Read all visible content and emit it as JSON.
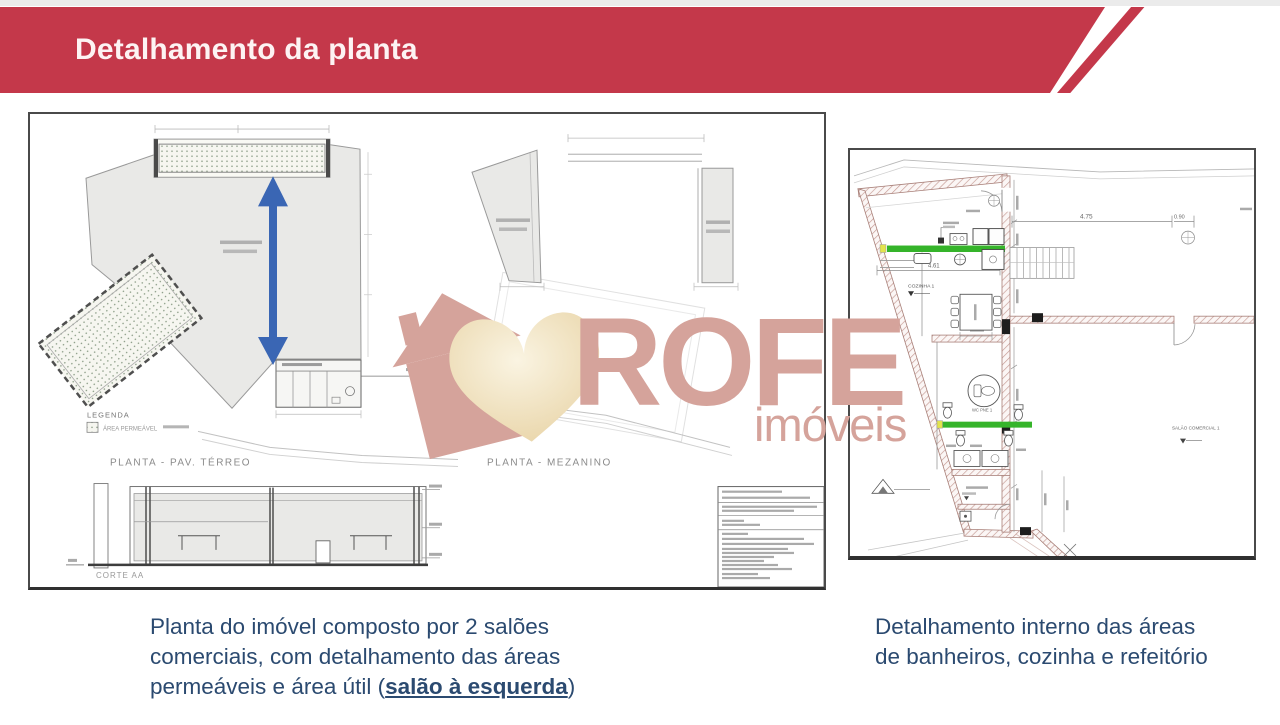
{
  "header": {
    "title": "Detalhamento da planta",
    "accent_color": "#c4384a"
  },
  "watermark": {
    "brand": "ROFE",
    "sub_brand": "imóveis",
    "color": "#d5a39b",
    "logo": "house-heart-icon"
  },
  "left_panel": {
    "legend": {
      "title": "LEGENDA",
      "item": "ÁREA PERMEÁVEL"
    },
    "plan_terreo": {
      "caption": "PLANTA - PAV. TÉRREO"
    },
    "plan_mezanino": {
      "caption": "PLANTA - MEZANINO"
    },
    "section": {
      "caption": "CORTE AA"
    }
  },
  "right_panel": {
    "labels": {
      "kitchen": "COZINHA 1",
      "wc_pne": "WC PNE 1",
      "hall": "SALÃO COMERCIAL 1"
    },
    "dimensions": {
      "top_width": "4.75",
      "door_width": "0.90",
      "kitchen_width": "4.61"
    },
    "highlight_green": "#35b42a"
  },
  "captions": {
    "left_prefix": "Planta do imóvel composto por 2 salões comerciais, com detalhamento das áreas permeáveis e área útil (",
    "left_highlight": "salão à esquerda",
    "left_suffix": ")",
    "right": "Detalhamento interno das áreas de banheiros, cozinha e refeitório"
  },
  "colors": {
    "caption_text": "#2b4a70",
    "permeable_dot": "#8fa08a",
    "plan_fill": "#e9e9e7"
  }
}
